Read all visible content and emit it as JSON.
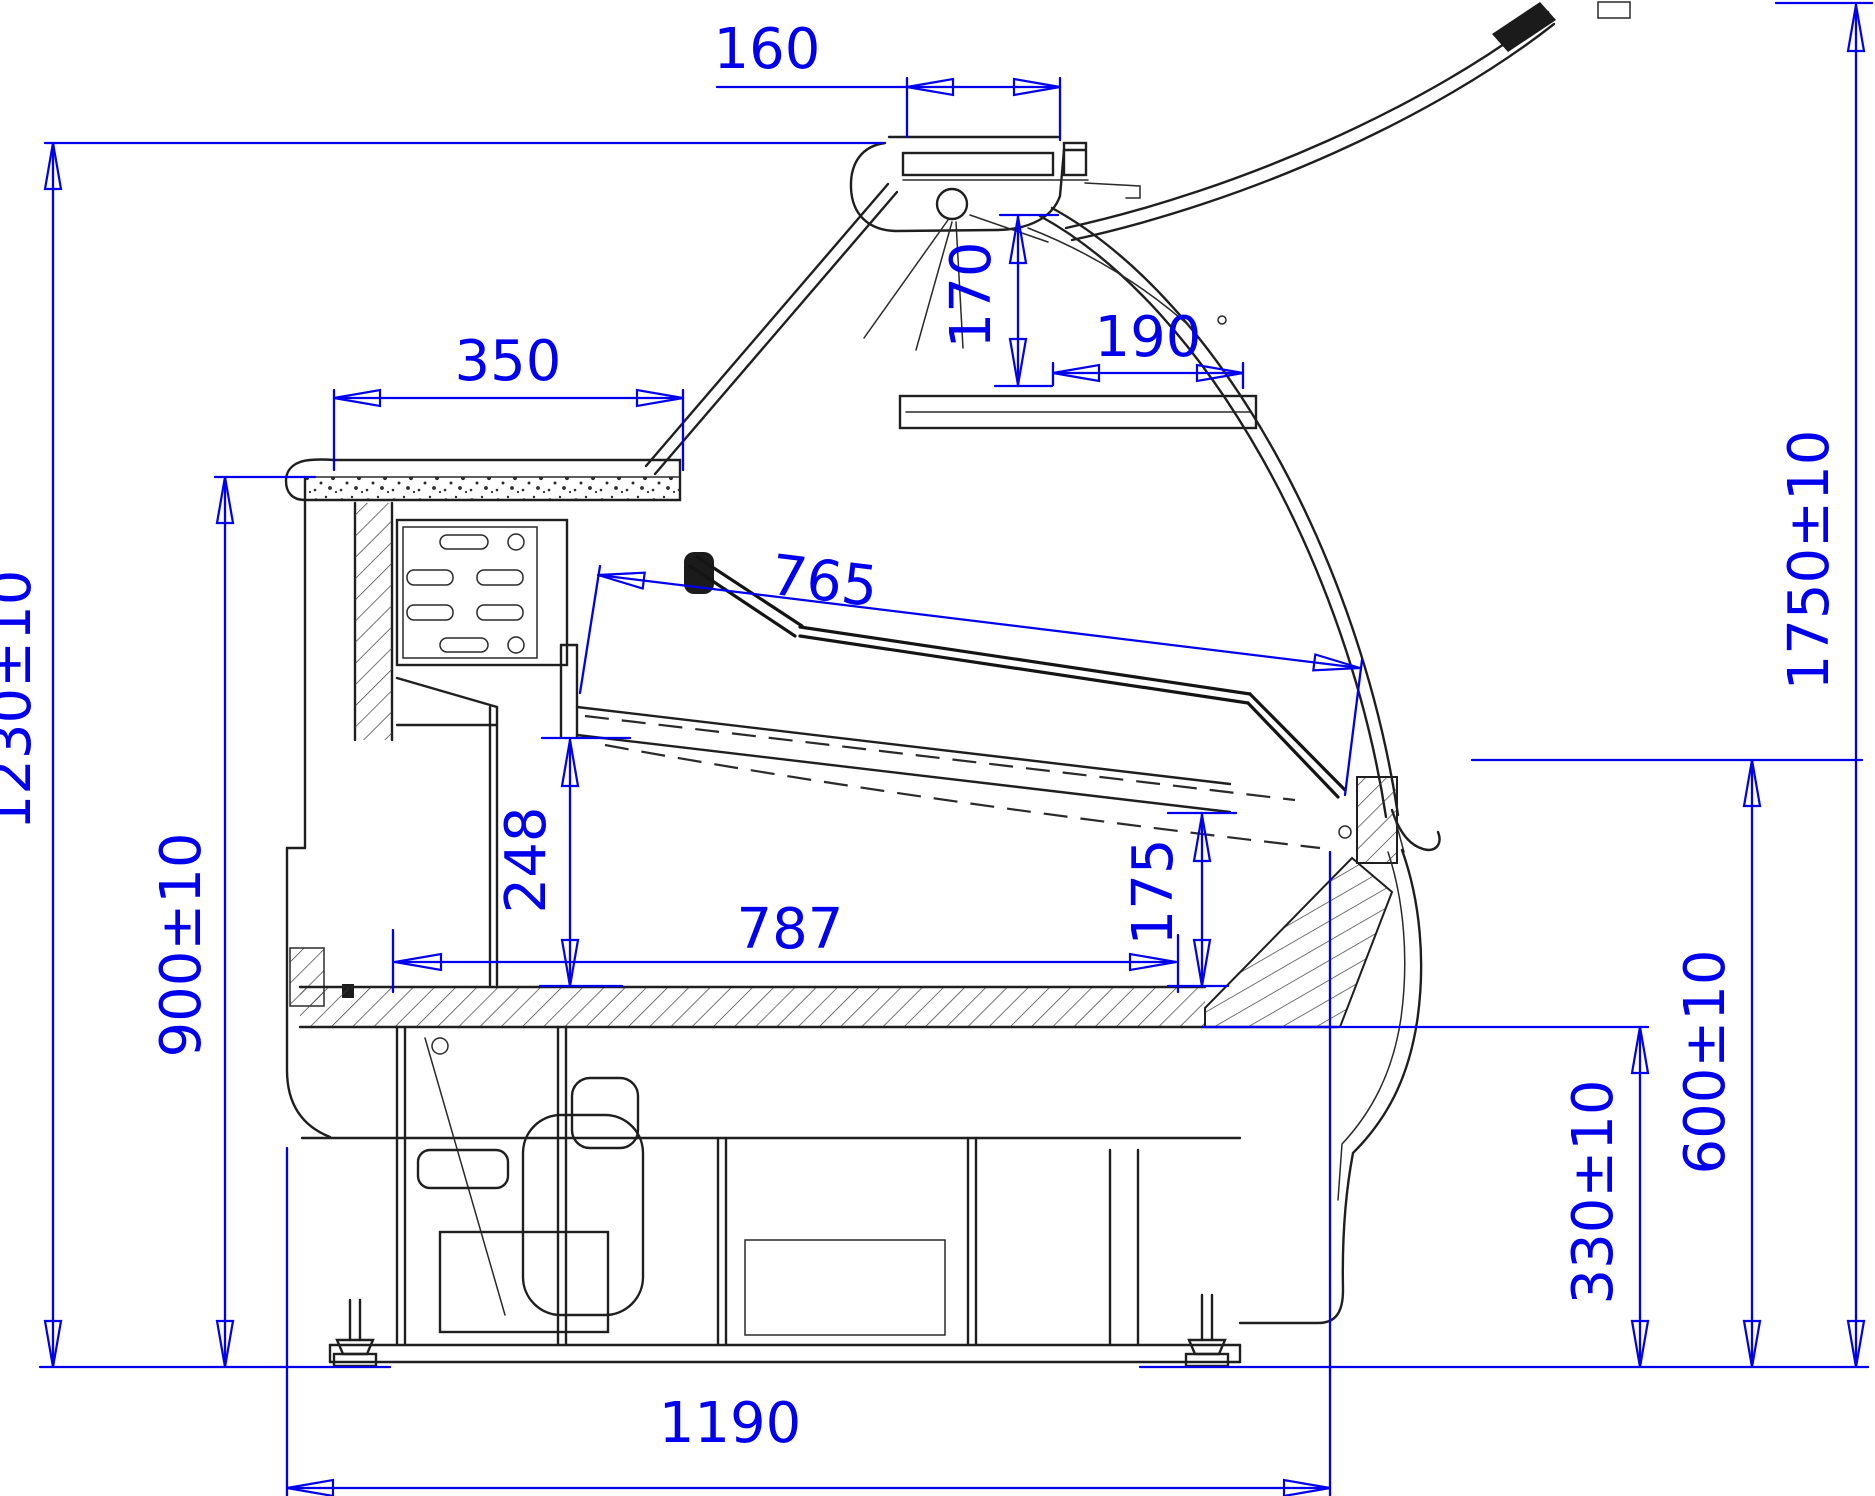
{
  "drawing": {
    "kind": "technical-section-drawing",
    "subject": "refrigerated serve-over display counter, side cross-section with dimension annotations",
    "background_color": "#ffffff",
    "linework_color": "#1f1f1f",
    "dimension_color": "#0000ee",
    "dims": {
      "d160": "160",
      "d170": "170",
      "d190": "190",
      "d350": "350",
      "d765": "765",
      "d248": "248",
      "d175": "175",
      "d787": "787",
      "d1230": "1230±10",
      "d900": "900±10",
      "d1750": "1750±10",
      "d600": "600±10",
      "d330": "330±10",
      "d1190": "1190"
    }
  }
}
